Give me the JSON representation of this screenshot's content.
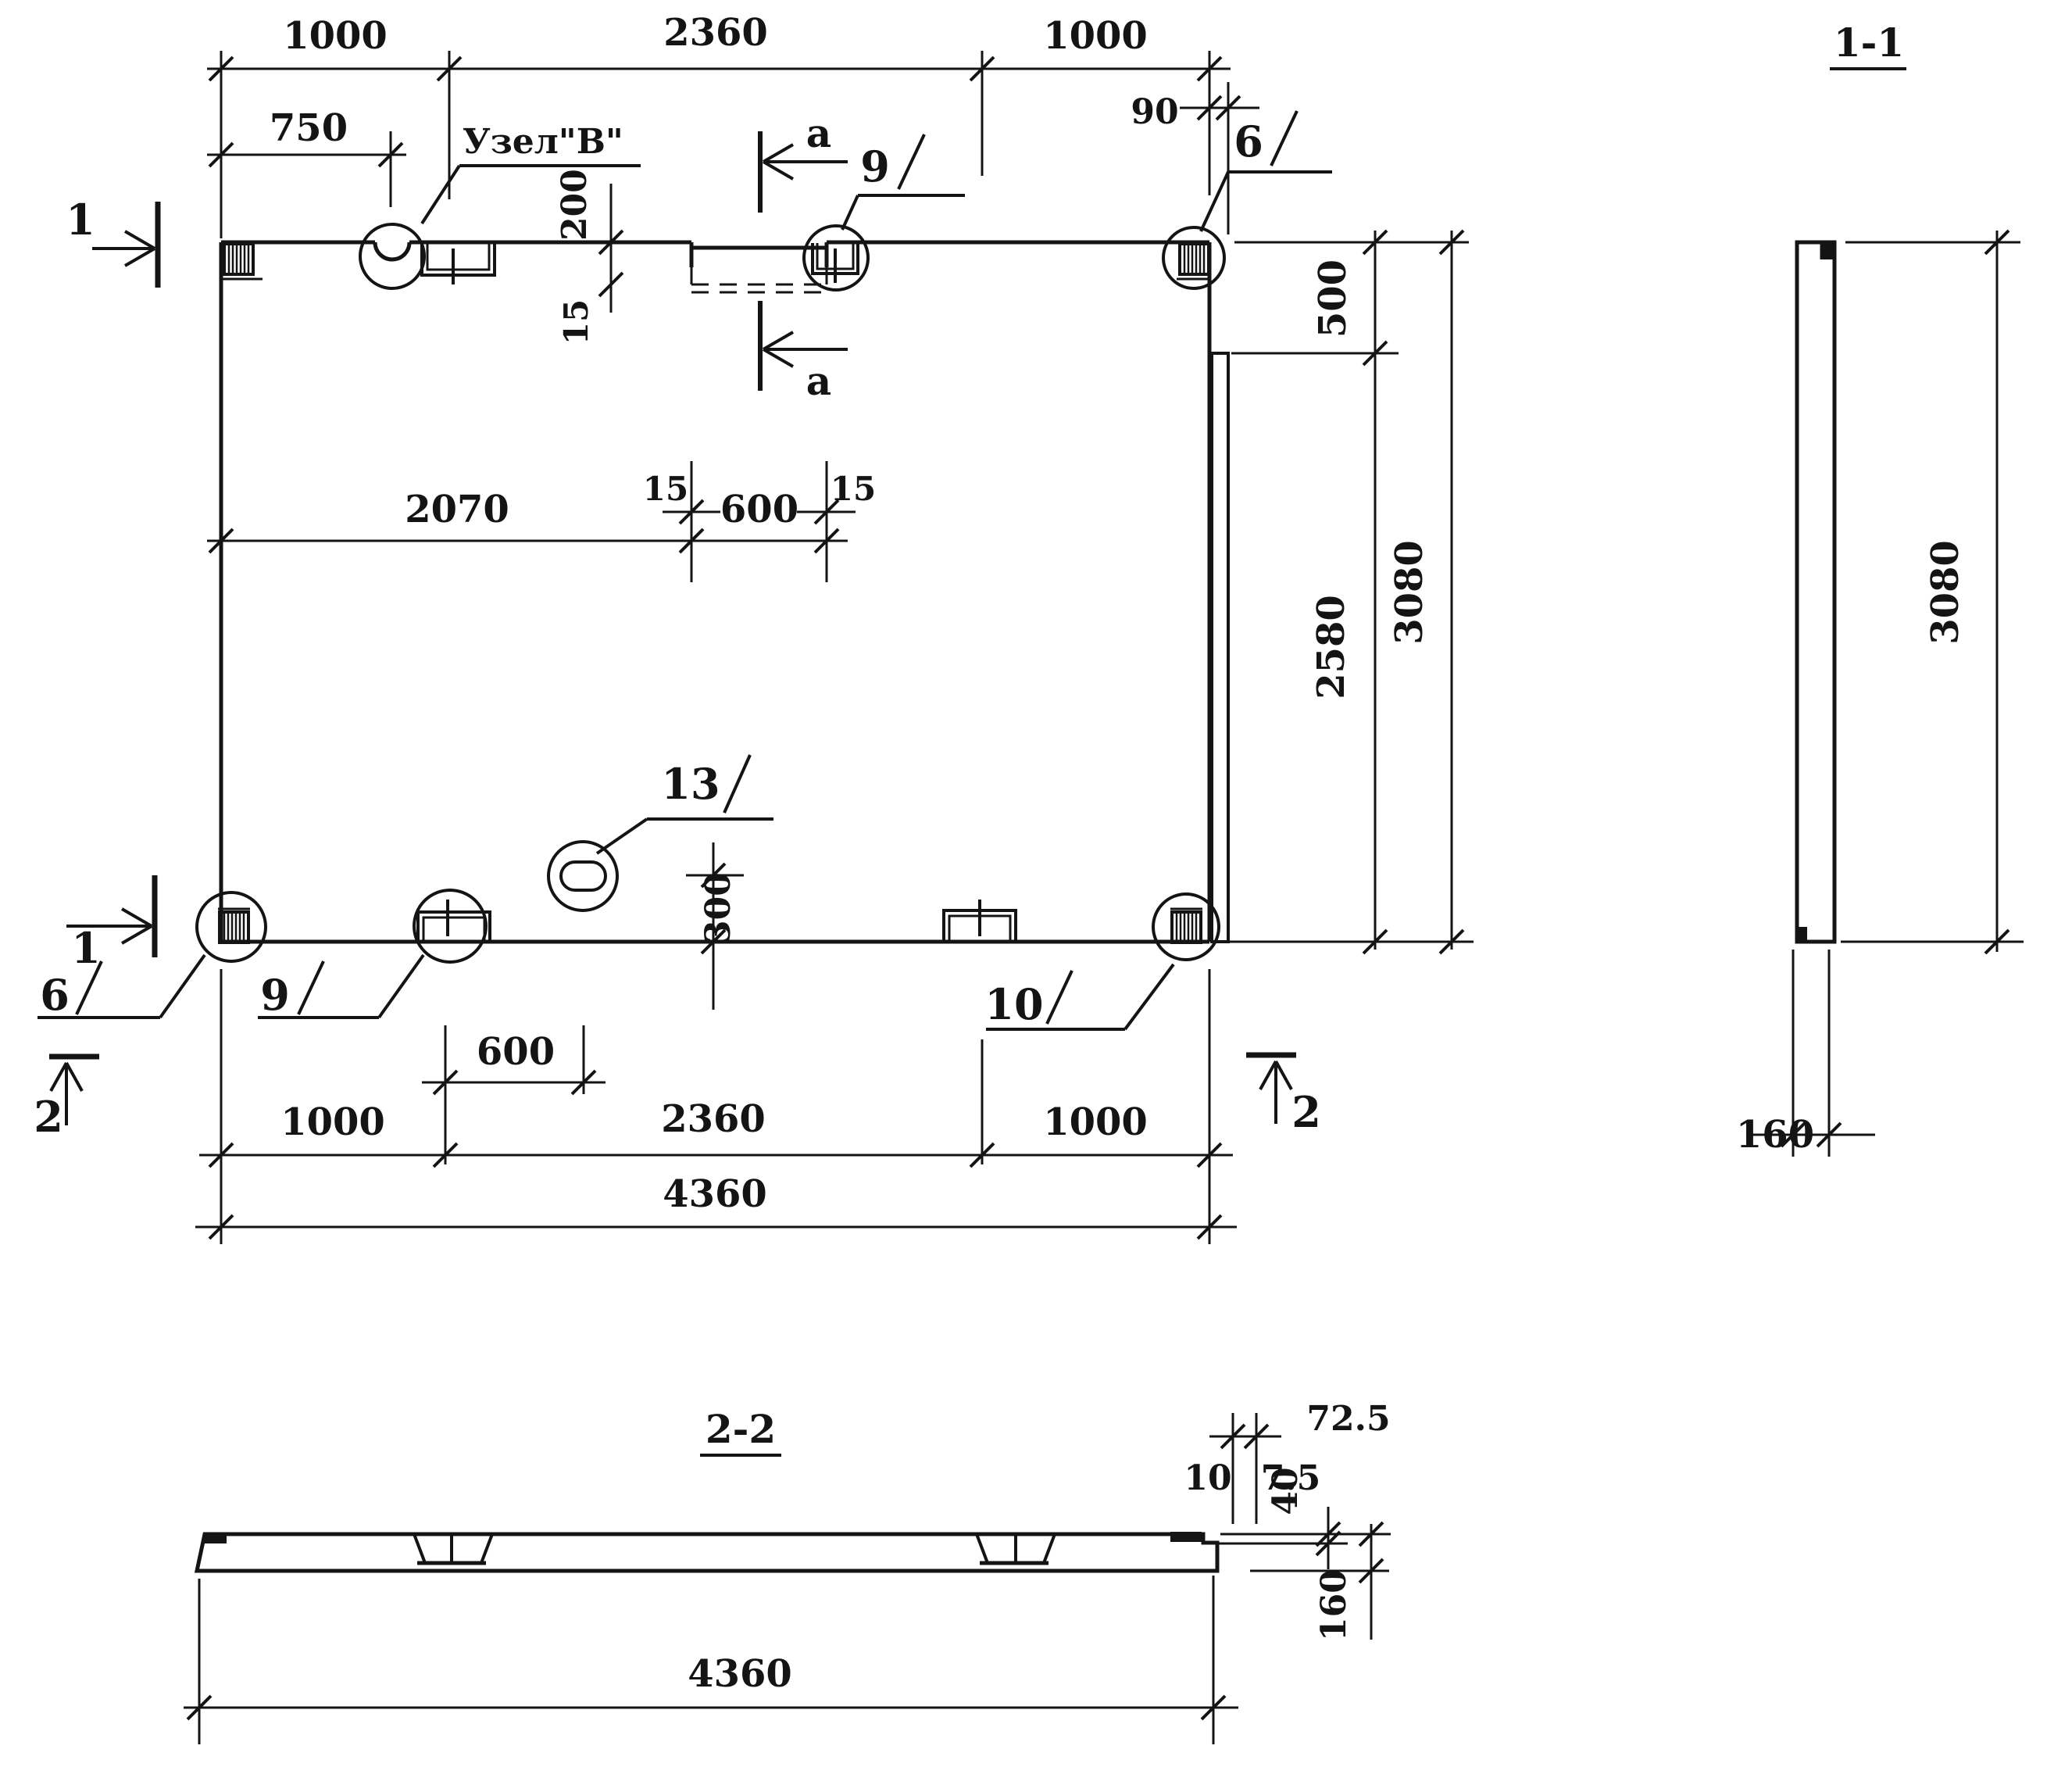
{
  "plan": {
    "dims_top": {
      "left_1000": "1000",
      "mid_2360": "2360",
      "right_1000": "1000",
      "d750": "750",
      "d90": "90",
      "d200": "200",
      "d15": "15"
    },
    "dims_mid": {
      "d2070": "2070",
      "d600": "600",
      "d15_left": "15",
      "d15_right": "15"
    },
    "dims_right": {
      "d500": "500",
      "d2580": "2580",
      "d3080": "3080"
    },
    "dims_bottom": {
      "d600": "600",
      "left_1000": "1000",
      "mid_2360": "2360",
      "right_1000": "1000",
      "d4360": "4360",
      "d300": "300"
    },
    "callouts": {
      "node_b": "Узел\"В\"",
      "top_9": "9",
      "top_6": "6",
      "bottom_6": "6",
      "bottom_9": "9",
      "bottom_10": "10",
      "hole_13": "13"
    },
    "marks": {
      "section_1": "1",
      "section_2": "2",
      "section_a": "a"
    }
  },
  "section_1_1": {
    "title": "1-1",
    "d3080": "3080",
    "d160": "160"
  },
  "section_2_2": {
    "title": "2-2",
    "d72_5": "72.5",
    "d10": "10",
    "d7_5": "7.5",
    "d40": "40",
    "d160": "160",
    "d4360": "4360"
  },
  "colors": {
    "ink": "#141414",
    "paper": "#ffffff"
  }
}
